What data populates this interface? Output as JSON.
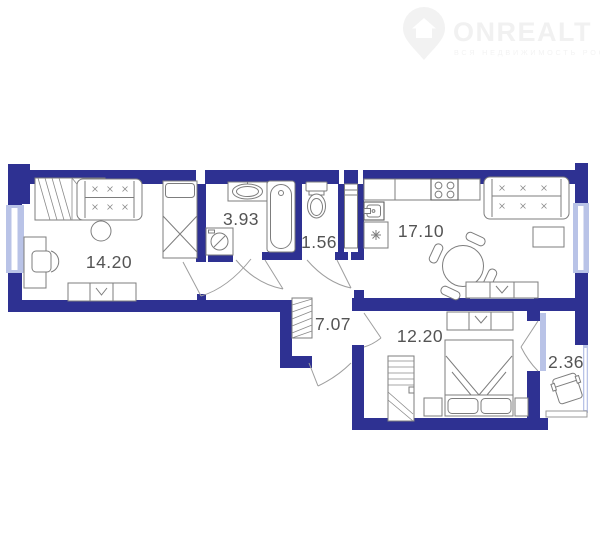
{
  "watermark": {
    "brand": "ONREALT",
    "tagline": "ВСЯ НЕДВИЖИМОСТЬ РОССИИ",
    "icon": "house-pin-icon",
    "color": "#f2f2f2"
  },
  "floorplan": {
    "wall_color": "#2e3192",
    "window_color": "#b9c3e7",
    "furniture_line_color": "#7d7d7d",
    "label_color": "#545454",
    "rooms": [
      {
        "name": "living-room",
        "area": "14.20"
      },
      {
        "name": "bathroom",
        "area": "3.93"
      },
      {
        "name": "wc",
        "area": "1.56"
      },
      {
        "name": "kitchen-living-room",
        "area": "17.10"
      },
      {
        "name": "hallway",
        "area": "7.07"
      },
      {
        "name": "bedroom",
        "area": "12.20"
      },
      {
        "name": "balcony",
        "area": "2.36"
      }
    ]
  }
}
